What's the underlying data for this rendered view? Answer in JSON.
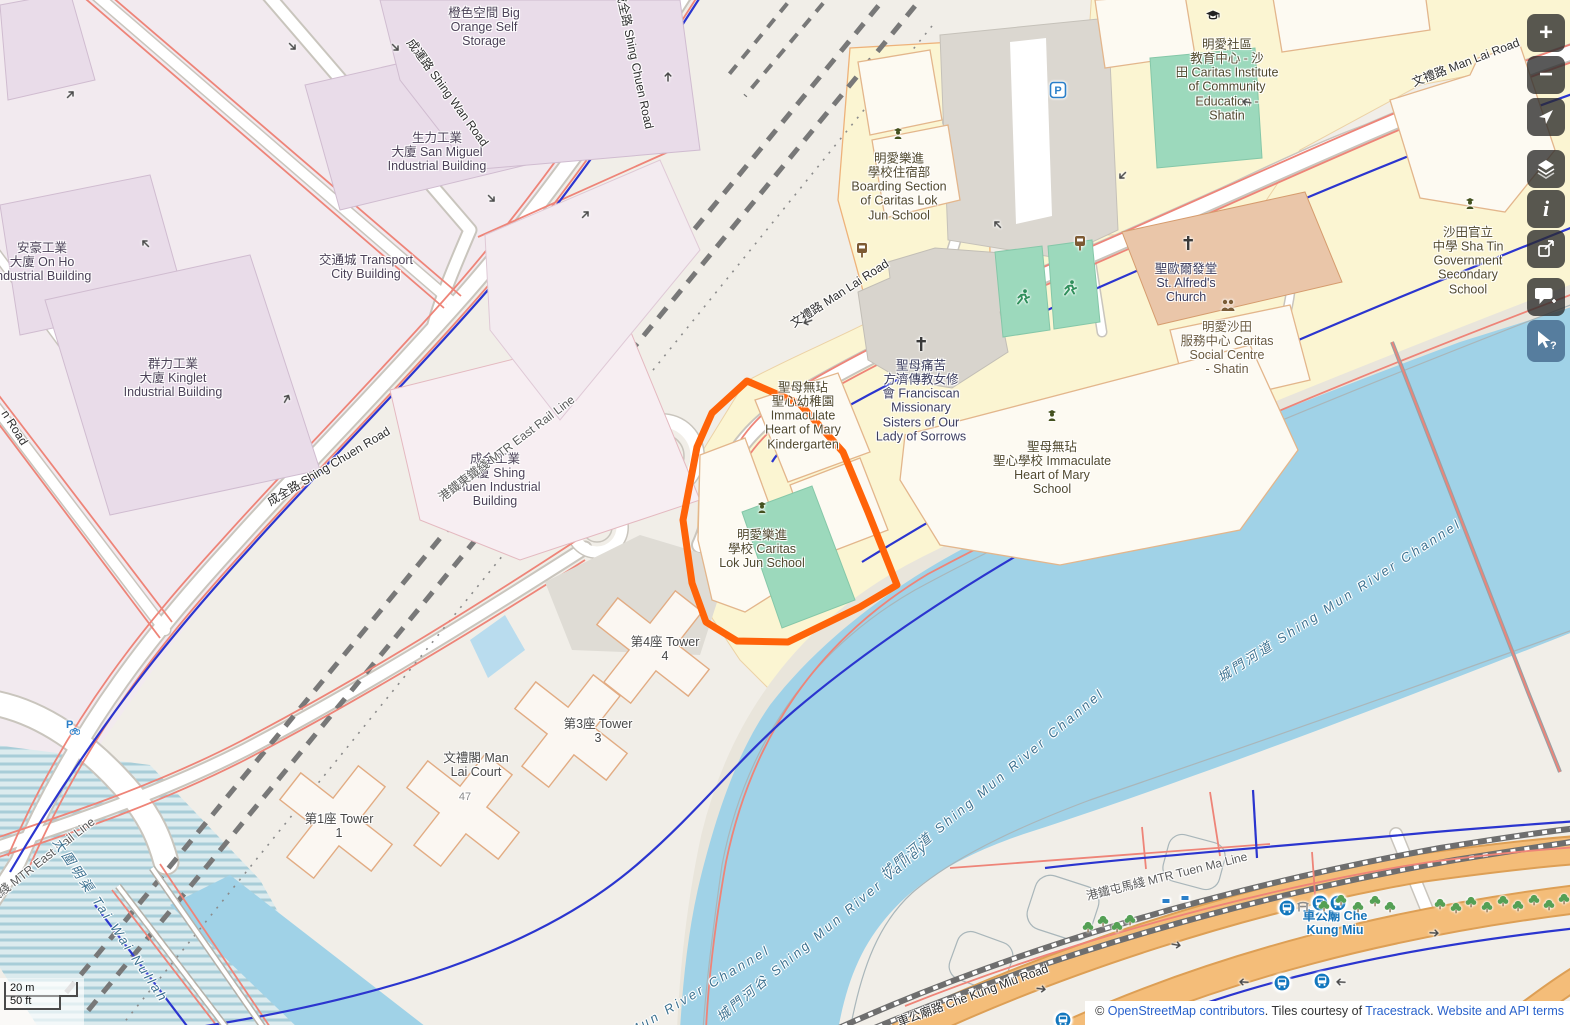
{
  "app": {
    "name": "OpenStreetMap map view"
  },
  "colors": {
    "highlight": "#ff6309",
    "water": "#a0d2e7",
    "trunk_road": "#f4bd79",
    "pitch_green": "#9cd9bc",
    "school_area": "#fbf5d2",
    "industrial_area": "#f2eaef",
    "link_blue": "#2962cc",
    "transit_label": "#1673b8"
  },
  "map_labels": [
    {
      "id": "big-orange-self-storage",
      "cls": "",
      "x": 484,
      "y": 27,
      "rot": 0,
      "text": "橙色空間 Big\nOrange Self\nStorage"
    },
    {
      "id": "san-miguel-industrial-building",
      "cls": "",
      "x": 437,
      "y": 152,
      "rot": 0,
      "text": "生力工業\n大廈 San Miguel\nIndustrial Building"
    },
    {
      "id": "on-ho-industrial-building",
      "cls": "",
      "x": 42,
      "y": 262,
      "rot": 0,
      "text": "安豪工業\n大廈 On Ho\nIndustrial Building"
    },
    {
      "id": "kinglet-industrial-building",
      "cls": "",
      "x": 173,
      "y": 378,
      "rot": 0,
      "text": "群力工業\n大廈 Kinglet\nIndustrial Building"
    },
    {
      "id": "shing-chuen-industrial-building",
      "cls": "",
      "x": 495,
      "y": 480,
      "rot": 0,
      "text": "成全工業\n大廈 Shing\nChuen Industrial\nBuilding"
    },
    {
      "id": "transport-city-building",
      "cls": "",
      "x": 366,
      "y": 267,
      "rot": 0,
      "text": "交通城 Transport\nCity Building"
    },
    {
      "id": "boarding-section-caritas-lok-jun",
      "cls": "poi-school",
      "x": 899,
      "y": 187,
      "rot": 0,
      "text": "明愛樂進\n學校住宿部\nBoarding Section\nof Caritas Lok\nJun School"
    },
    {
      "id": "caritas-institute",
      "cls": "poi-school",
      "x": 1227,
      "y": 80,
      "rot": 0,
      "text": "明愛社區\n教育中心 - 沙\n田 Caritas Institute\nof Community\nEducation -\nShatin"
    },
    {
      "id": "st-alfreds-church",
      "cls": "poi-church",
      "x": 1186,
      "y": 283,
      "rot": 0,
      "text": "聖歐爾發堂\nSt. Alfred's\nChurch"
    },
    {
      "id": "caritas-social-centre",
      "cls": "poi-brown",
      "x": 1227,
      "y": 348,
      "rot": 0,
      "text": "明愛沙田\n服務中心 Caritas\nSocial Centre\n- Shatin"
    },
    {
      "id": "shatin-government-secondary-school",
      "cls": "poi-school",
      "x": 1468,
      "y": 261,
      "rot": 0,
      "text": "沙田官立\n中學 Sha Tin\nGovernment\nSecondary\nSchool"
    },
    {
      "id": "franciscan-missionary-sisters",
      "cls": "poi-church",
      "x": 921,
      "y": 401,
      "rot": 0,
      "text": "聖母痛苦\n方濟傳教女修\n會 Franciscan\nMissionary\nSisters of Our\nLady of Sorrows"
    },
    {
      "id": "ihm-kindergarten",
      "cls": "poi-school",
      "x": 803,
      "y": 416,
      "rot": 0,
      "text": "聖母無玷\n聖心幼稚園\nImmaculate\nHeart of Mary\nKindergarten"
    },
    {
      "id": "ihm-school",
      "cls": "poi-school",
      "x": 1052,
      "y": 468,
      "rot": 0,
      "text": "聖母無玷\n聖心學校 Immaculate\nHeart of Mary\nSchool"
    },
    {
      "id": "caritas-lok-jun-school",
      "cls": "poi-school",
      "x": 762,
      "y": 549,
      "rot": 0,
      "text": "明愛樂進\n學校 Caritas\nLok Jun School"
    },
    {
      "id": "tower-4",
      "cls": "poi-gray",
      "x": 665,
      "y": 649,
      "rot": 0,
      "text": "第4座 Tower\n4"
    },
    {
      "id": "tower-3",
      "cls": "poi-gray",
      "x": 598,
      "y": 731,
      "rot": 0,
      "text": "第3座 Tower\n3"
    },
    {
      "id": "man-lai-court",
      "cls": "poi-gray",
      "x": 476,
      "y": 765,
      "rot": 0,
      "text": "文禮閣 Man\nLai Court"
    },
    {
      "id": "house-number-47",
      "cls": "house",
      "x": 465,
      "y": 797,
      "rot": 0,
      "text": "47"
    },
    {
      "id": "tower-1",
      "cls": "poi-gray",
      "x": 339,
      "y": 826,
      "rot": 0,
      "text": "第1座 Tower\n1"
    },
    {
      "id": "che-kung-miu",
      "cls": "transit",
      "x": 1335,
      "y": 923,
      "rot": 0,
      "text": "車公廟 Che\nKung Miu"
    },
    {
      "id": "shing-wan-road",
      "cls": "road",
      "x": 447,
      "y": 93,
      "rot": 54,
      "text": "成運路 Shing Wan Road"
    },
    {
      "id": "shing-chuen-road-top",
      "cls": "road",
      "x": 634,
      "y": 60,
      "rot": 78,
      "text": "成全路 Shing Chuen Road"
    },
    {
      "id": "shing-chuen-road-mid",
      "cls": "road",
      "x": 329,
      "y": 467,
      "rot": -31,
      "text": "成全路 Shing Chuen Road"
    },
    {
      "id": "man-lai-road-mid",
      "cls": "road",
      "x": 840,
      "y": 294,
      "rot": -33,
      "text": "文禮路 Man Lai Road"
    },
    {
      "id": "man-lai-road-top",
      "cls": "road",
      "x": 1466,
      "y": 63,
      "rot": -21,
      "text": "文禮路 Man Lai Road"
    },
    {
      "id": "che-kung-miu-road",
      "cls": "road",
      "x": 973,
      "y": 996,
      "rot": -20,
      "text": "車公廟路 Che Kung Miu Road"
    },
    {
      "id": "unknown-road-partial",
      "cls": "road",
      "x": 14,
      "y": 428,
      "rot": 58,
      "text": "n Road"
    },
    {
      "id": "mtr-east-rail-line-mid",
      "cls": "rail",
      "x": 507,
      "y": 449,
      "rot": -37,
      "text": "港鐵東鐵綫 MTR East Rail Line"
    },
    {
      "id": "mtr-east-rail-line-bottom",
      "cls": "rail",
      "x": 28,
      "y": 872,
      "rot": -38,
      "text": "港鐵東鐵綫 MTR East Rail Line"
    },
    {
      "id": "mtr-tuen-ma-line",
      "cls": "rail",
      "x": 1167,
      "y": 877,
      "rot": -14,
      "text": "港鐵屯馬綫 MTR Tuen Ma Line"
    },
    {
      "id": "tai-wai-nullah",
      "cls": "water",
      "x": 110,
      "y": 921,
      "rot": 56,
      "text": "大圍明渠 Tai Wai Nullah"
    },
    {
      "id": "shing-mun-river-channel-upper",
      "cls": "water",
      "x": 1340,
      "y": 601,
      "rot": -33,
      "text": "城門河道 Shing Mun River Channel"
    },
    {
      "id": "shing-mun-river-channel-mid",
      "cls": "water",
      "x": 993,
      "y": 784,
      "rot": -40,
      "text": "城門河道 Shing Mun River Channel"
    },
    {
      "id": "shing-mun-river-valley",
      "cls": "water",
      "x": 823,
      "y": 932,
      "rot": -40,
      "text": "城門河谷 Shing Mun River Valley"
    },
    {
      "id": "shing-mun-river-channel-partial",
      "cls": "water",
      "x": 700,
      "y": 991,
      "rot": -31,
      "text": "Mun River Channel"
    }
  ],
  "icons": [
    {
      "type": "school-icon",
      "x": 898,
      "y": 133
    },
    {
      "type": "school-icon",
      "x": 762,
      "y": 507
    },
    {
      "type": "school-icon",
      "x": 1052,
      "y": 415
    },
    {
      "type": "school-icon",
      "x": 1470,
      "y": 203
    },
    {
      "type": "grad-cap-icon",
      "x": 1213,
      "y": 15
    },
    {
      "type": "cross-icon",
      "x": 1188,
      "y": 243
    },
    {
      "type": "cross-icon",
      "x": 921,
      "y": 344
    },
    {
      "type": "community-icon",
      "x": 1228,
      "y": 305
    },
    {
      "type": "runner-icon",
      "x": 1023,
      "y": 297
    },
    {
      "type": "runner-icon",
      "x": 1070,
      "y": 288
    },
    {
      "type": "parking-icon",
      "x": 1058,
      "y": 90
    },
    {
      "type": "bike-parking-icon",
      "x": 71,
      "y": 727
    },
    {
      "type": "bus-stop-brown-icon",
      "x": 1080,
      "y": 243
    },
    {
      "type": "bus-stop-brown-icon",
      "x": 862,
      "y": 250
    },
    {
      "type": "bus-blue-icon",
      "x": 1287,
      "y": 908
    },
    {
      "type": "bus-blue-icon",
      "x": 1320,
      "y": 903
    },
    {
      "type": "bus-blue-icon",
      "x": 1338,
      "y": 903
    },
    {
      "type": "bus-blue-icon",
      "x": 1282,
      "y": 983
    },
    {
      "type": "bus-blue-icon",
      "x": 1322,
      "y": 981
    },
    {
      "type": "bus-blue-icon",
      "x": 1063,
      "y": 1020
    },
    {
      "type": "bus-blue-icon",
      "x": 1236,
      "y": 1022
    },
    {
      "type": "shrine-icon",
      "x": 1303,
      "y": 906
    },
    {
      "type": "station-marker-icon",
      "x": 1166,
      "y": 901
    },
    {
      "type": "station-marker-icon",
      "x": 1185,
      "y": 898
    },
    {
      "type": "tree-icon",
      "x": 1088,
      "y": 927
    },
    {
      "type": "tree-icon",
      "x": 1103,
      "y": 921
    },
    {
      "type": "tree-icon",
      "x": 1117,
      "y": 927
    },
    {
      "type": "tree-icon",
      "x": 1130,
      "y": 920
    },
    {
      "type": "tree-icon",
      "x": 1324,
      "y": 906
    },
    {
      "type": "tree-icon",
      "x": 1341,
      "y": 900
    },
    {
      "type": "tree-icon",
      "x": 1358,
      "y": 907
    },
    {
      "type": "tree-icon",
      "x": 1375,
      "y": 901
    },
    {
      "type": "tree-icon",
      "x": 1390,
      "y": 907
    },
    {
      "type": "tree-icon",
      "x": 1440,
      "y": 904
    },
    {
      "type": "tree-icon",
      "x": 1456,
      "y": 908
    },
    {
      "type": "tree-icon",
      "x": 1471,
      "y": 902
    },
    {
      "type": "tree-icon",
      "x": 1487,
      "y": 907
    },
    {
      "type": "tree-icon",
      "x": 1503,
      "y": 901
    },
    {
      "type": "tree-icon",
      "x": 1518,
      "y": 906
    },
    {
      "type": "tree-icon",
      "x": 1534,
      "y": 900
    },
    {
      "type": "tree-icon",
      "x": 1549,
      "y": 905
    },
    {
      "type": "tree-icon",
      "x": 1564,
      "y": 899
    },
    {
      "type": "oneway-arrow-icon",
      "x": 293,
      "y": 47,
      "rot": 45
    },
    {
      "type": "oneway-arrow-icon",
      "x": 71,
      "y": 94,
      "rot": -45
    },
    {
      "type": "oneway-arrow-icon",
      "x": 145,
      "y": 243,
      "rot": -135
    },
    {
      "type": "oneway-arrow-icon",
      "x": 396,
      "y": 48,
      "rot": 45
    },
    {
      "type": "oneway-arrow-icon",
      "x": 492,
      "y": 199,
      "rot": 45
    },
    {
      "type": "oneway-arrow-icon",
      "x": 586,
      "y": 214,
      "rot": -45
    },
    {
      "type": "oneway-arrow-icon",
      "x": 668,
      "y": 76,
      "rot": -90
    },
    {
      "type": "oneway-arrow-icon",
      "x": 1246,
      "y": 102,
      "rot": 190
    },
    {
      "type": "oneway-arrow-icon",
      "x": 1122,
      "y": 176,
      "rot": 135
    },
    {
      "type": "oneway-arrow-icon",
      "x": 997,
      "y": 224,
      "rot": -135
    },
    {
      "type": "oneway-arrow-icon",
      "x": 807,
      "y": 322,
      "rot": 160
    },
    {
      "type": "oneway-arrow-icon",
      "x": 287,
      "y": 398,
      "rot": -60
    },
    {
      "type": "oneway-arrow-icon",
      "x": 1177,
      "y": 945,
      "rot": 10
    },
    {
      "type": "oneway-arrow-icon",
      "x": 1435,
      "y": 933,
      "rot": 3
    },
    {
      "type": "oneway-arrow-icon",
      "x": 1340,
      "y": 982,
      "rot": 183
    },
    {
      "type": "oneway-arrow-icon",
      "x": 1243,
      "y": 982,
      "rot": 183
    },
    {
      "type": "oneway-arrow-icon",
      "x": 1042,
      "y": 989,
      "rot": 8
    }
  ],
  "controls": {
    "zoom_in": "+",
    "zoom_out": "−",
    "info": "i",
    "query_help": "?"
  },
  "scalebar": {
    "metric": "20 m",
    "imperial": "50 ft"
  },
  "attribution": {
    "copyright_prefix": "© ",
    "osm_link": "OpenStreetMap contributors",
    "middle": ". Tiles courtesy of ",
    "tracestrack_link": "Tracestrack",
    "period": ". ",
    "terms_link": "Website and API terms"
  }
}
